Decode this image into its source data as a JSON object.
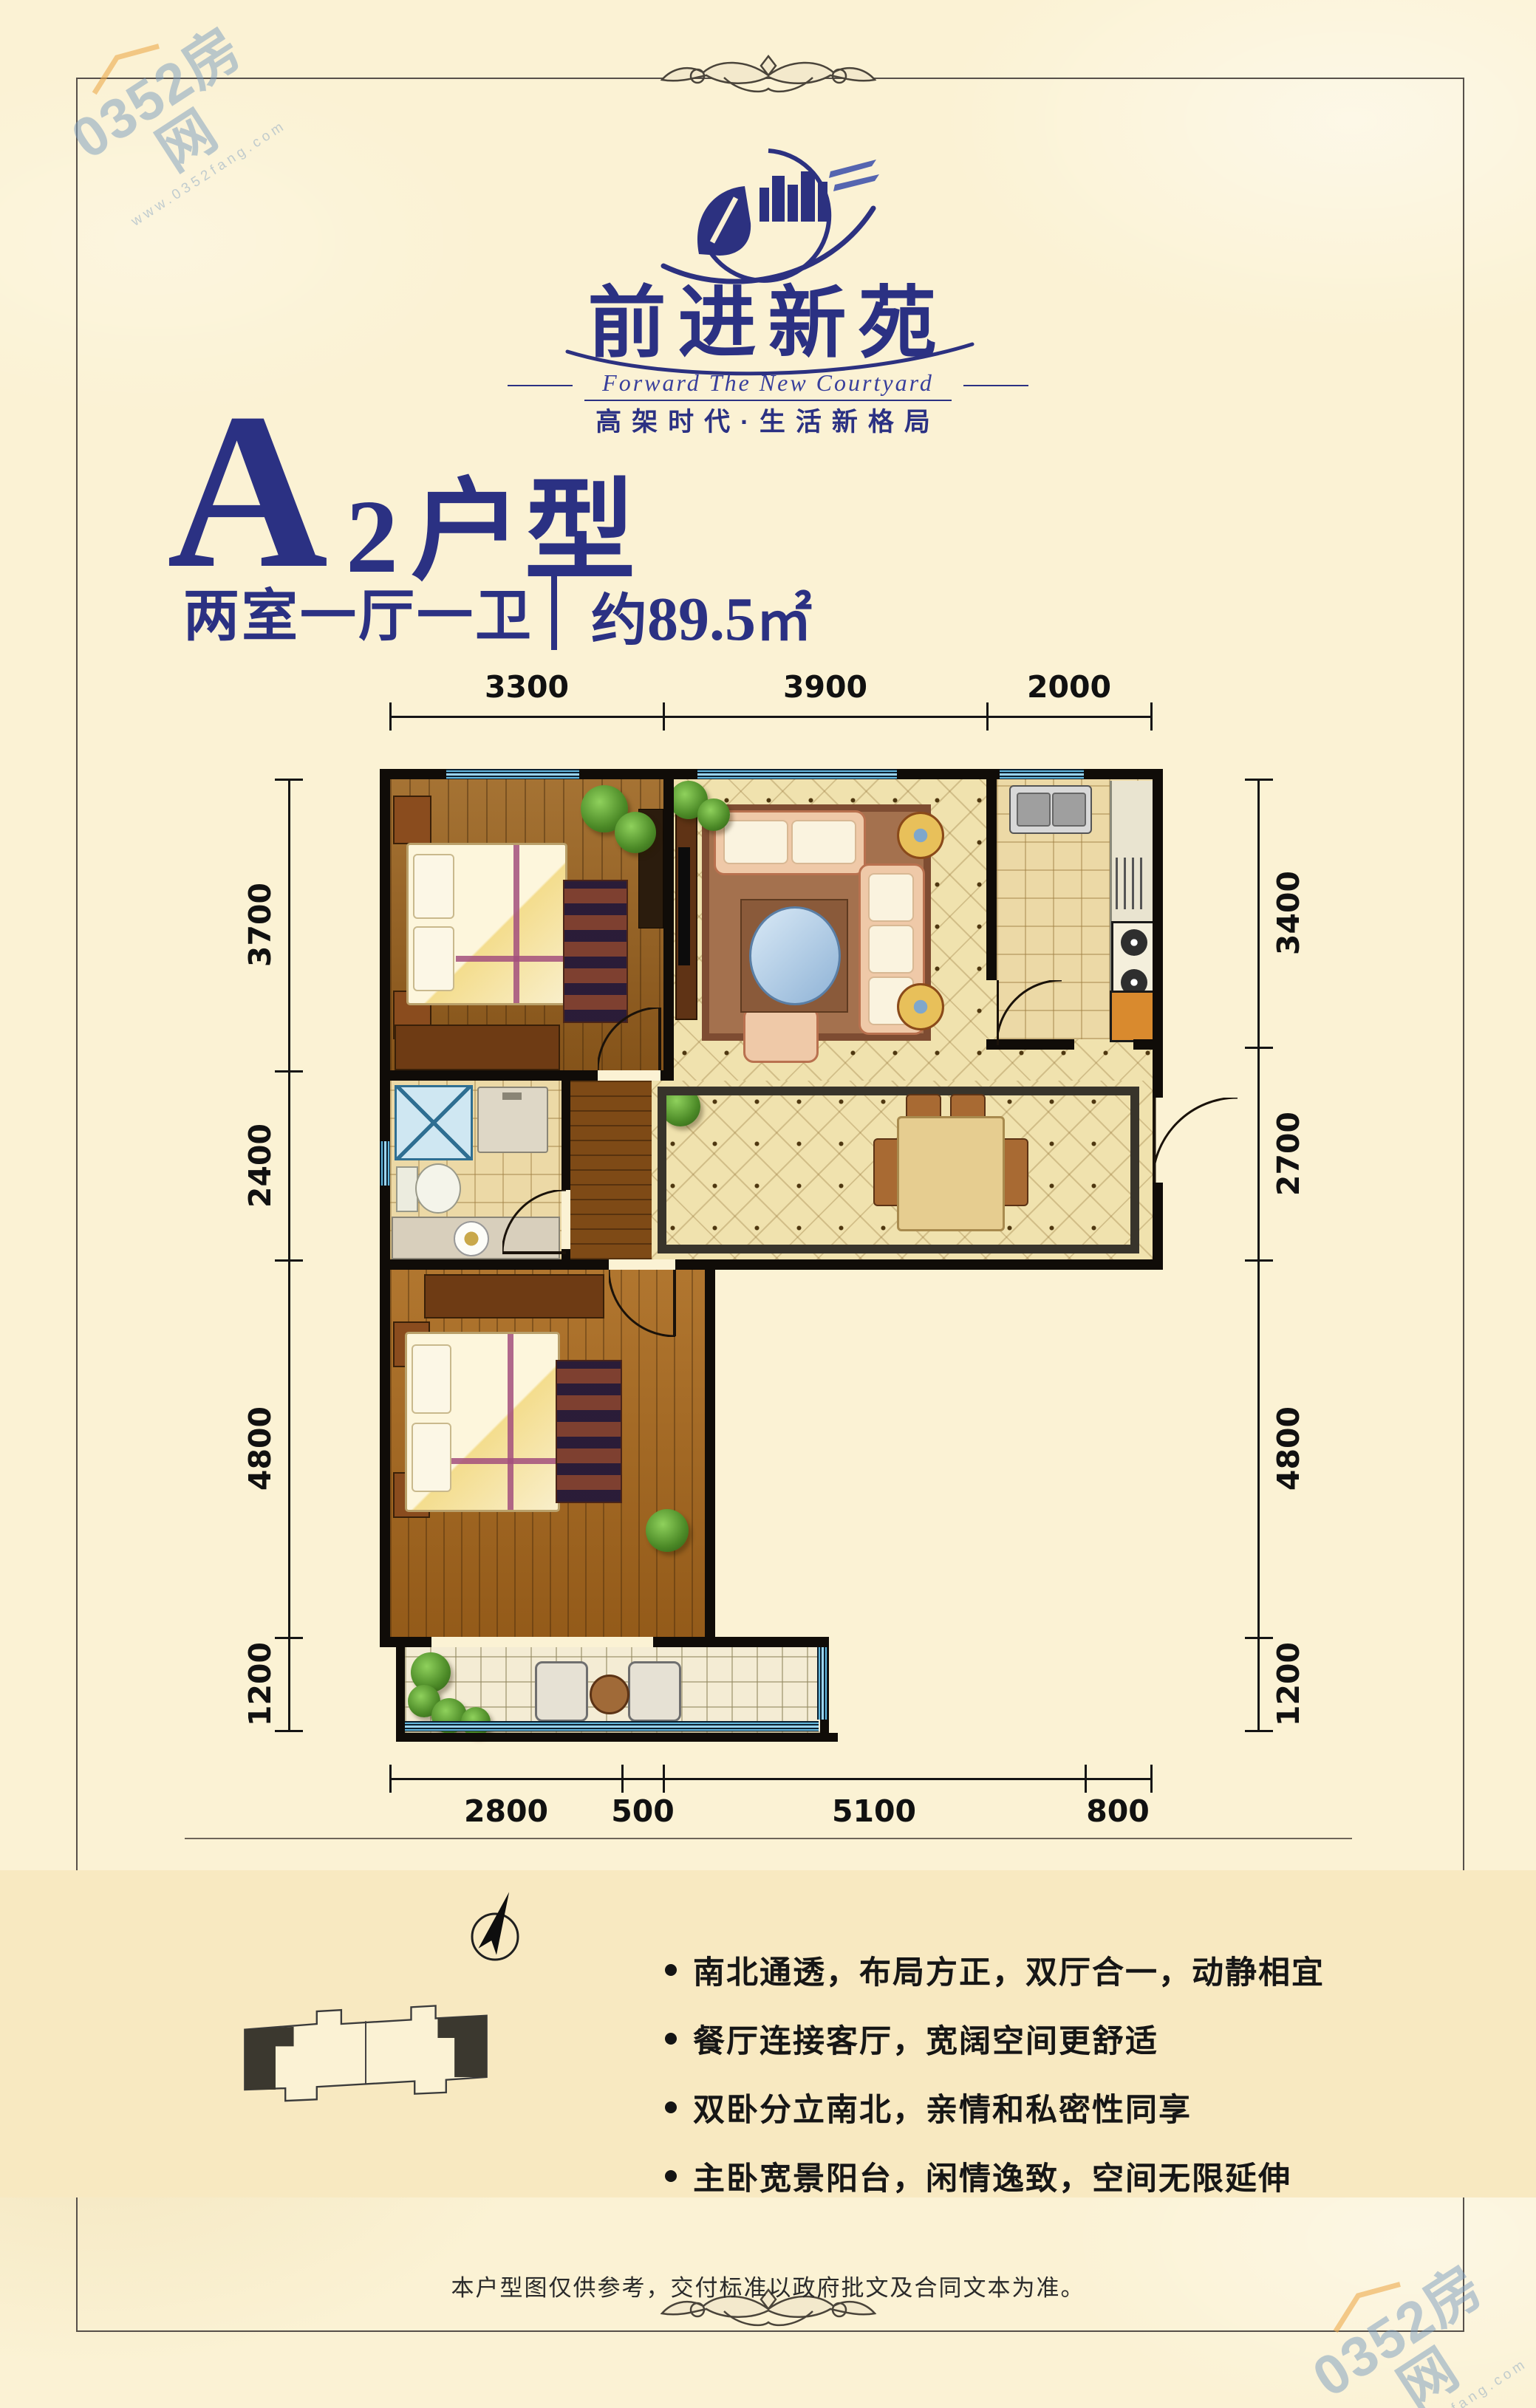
{
  "watermark": {
    "text": "0352房网",
    "url": "www.0352fang.com"
  },
  "brand": {
    "name": "前进新苑",
    "english": "Forward The New Courtyard",
    "slogan": "高架时代·生活新格局"
  },
  "unit": {
    "letter": "A",
    "number": "2",
    "type_suffix": "户型",
    "layout": "两室一厅一卫",
    "area_prefix": "约",
    "area_value": "89.5",
    "area_unit": "㎡"
  },
  "plan": {
    "dims_top": [
      "3300",
      "3900",
      "2000"
    ],
    "dims_left": [
      "3700",
      "2400",
      "4800",
      "1200"
    ],
    "dims_right": [
      "3400",
      "2700",
      "4800",
      "1200"
    ],
    "dims_bottom": [
      "2800",
      "500",
      "5100",
      "800"
    ]
  },
  "features": [
    "南北通透，布局方正，双厅合一，动静相宜",
    "餐厅连接客厅，宽阔空间更舒适",
    "双卧分立南北，亲情和私密性同享",
    "主卧宽景阳台，闲情逸致，空间无限延伸"
  ],
  "footer": {
    "disclaimer": "本户型图仅供参考，交付标准以政府批文及合同文本为准。"
  }
}
